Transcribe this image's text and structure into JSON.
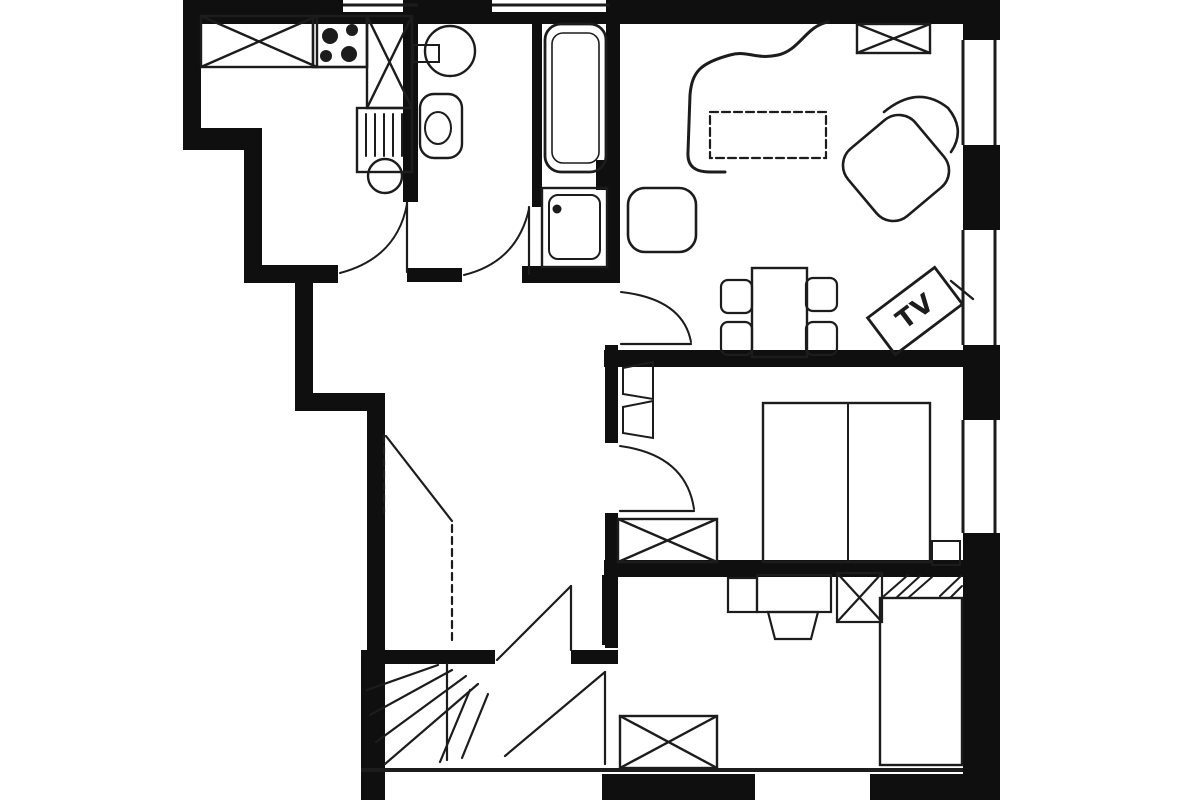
{
  "labels": {
    "tv": "TV"
  },
  "colors": {
    "paper": "#ffffff",
    "wall_ink": "#0f0f0f",
    "line_ink": "#1c1c1c"
  },
  "plan": {
    "walls": [
      {
        "name": "top-wall-west",
        "x": 183,
        "y": 0,
        "w": 160,
        "h": 24
      },
      {
        "name": "top-window1-sill",
        "x": 343,
        "y": 12,
        "w": 75,
        "h": 12
      },
      {
        "name": "top-wall-mid",
        "x": 418,
        "y": 0,
        "w": 74,
        "h": 24
      },
      {
        "name": "top-window2-sill",
        "x": 492,
        "y": 12,
        "w": 118,
        "h": 12
      },
      {
        "name": "top-wall-east",
        "x": 610,
        "y": 0,
        "w": 353,
        "h": 24
      },
      {
        "name": "corner-northeast",
        "x": 963,
        "y": 0,
        "w": 37,
        "h": 40
      },
      {
        "name": "left-wall-upper",
        "x": 183,
        "y": 0,
        "w": 18,
        "h": 150
      },
      {
        "name": "left-step-horizontal",
        "x": 183,
        "y": 128,
        "w": 79,
        "h": 22
      },
      {
        "name": "left-wall-mid",
        "x": 244,
        "y": 128,
        "w": 18,
        "h": 155
      },
      {
        "name": "kitchen-south-wall",
        "x": 244,
        "y": 265,
        "w": 94,
        "h": 18
      },
      {
        "name": "hall-west-wall-upper",
        "x": 295,
        "y": 283,
        "w": 18,
        "h": 127
      },
      {
        "name": "hall-step-horizontal",
        "x": 295,
        "y": 393,
        "w": 90,
        "h": 18
      },
      {
        "name": "hall-west-wall-lower",
        "x": 367,
        "y": 393,
        "w": 18,
        "h": 259
      },
      {
        "name": "left-wall-bottom",
        "x": 361,
        "y": 650,
        "w": 24,
        "h": 150
      },
      {
        "name": "kitchen-wc-wall",
        "x": 403,
        "y": 0,
        "w": 15,
        "h": 202
      },
      {
        "name": "wc-bath-wall",
        "x": 532,
        "y": 14,
        "w": 10,
        "h": 193
      },
      {
        "name": "bath-hall-wall",
        "x": 606,
        "y": 0,
        "w": 14,
        "h": 283
      },
      {
        "name": "wall-junction",
        "x": 596,
        "y": 160,
        "w": 24,
        "h": 30
      },
      {
        "name": "wc-south-wall",
        "x": 407,
        "y": 268,
        "w": 55,
        "h": 14
      },
      {
        "name": "bath-south-wall",
        "x": 522,
        "y": 266,
        "w": 98,
        "h": 17
      },
      {
        "name": "hall-east-wall-upper",
        "x": 605,
        "y": 345,
        "w": 13,
        "h": 98
      },
      {
        "name": "hall-east-wall-lower",
        "x": 605,
        "y": 513,
        "w": 13,
        "h": 135
      },
      {
        "name": "bedroom2-west-wall",
        "x": 602,
        "y": 575,
        "w": 16,
        "h": 70
      },
      {
        "name": "hall-south-wall-west",
        "x": 378,
        "y": 650,
        "w": 117,
        "h": 14
      },
      {
        "name": "hall-south-wall-east",
        "x": 571,
        "y": 650,
        "w": 47,
        "h": 14
      },
      {
        "name": "living-bedroom1-wall",
        "x": 604,
        "y": 350,
        "w": 359,
        "h": 17
      },
      {
        "name": "bedroom1-bedroom2-wall",
        "x": 604,
        "y": 560,
        "w": 359,
        "h": 17
      },
      {
        "name": "right-wall-1",
        "x": 963,
        "y": 145,
        "w": 37,
        "h": 85
      },
      {
        "name": "right-wall-2",
        "x": 963,
        "y": 345,
        "w": 37,
        "h": 75
      },
      {
        "name": "right-wall-3",
        "x": 963,
        "y": 533,
        "w": 37,
        "h": 267
      },
      {
        "name": "bottom-wall-mid",
        "x": 602,
        "y": 774,
        "w": 153,
        "h": 26
      },
      {
        "name": "bottom-wall-east",
        "x": 870,
        "y": 774,
        "w": 130,
        "h": 26
      }
    ],
    "window_lines": [
      {
        "name": "top-window1-line",
        "x1": 343,
        "y1": 5,
        "x2": 418,
        "y2": 5,
        "sw": 3
      },
      {
        "name": "top-window2-line",
        "x1": 492,
        "y1": 5,
        "x2": 610,
        "y2": 5,
        "sw": 3
      },
      {
        "name": "right-window1-inner",
        "x1": 963,
        "y1": 40,
        "x2": 963,
        "y2": 145,
        "sw": 3
      },
      {
        "name": "right-window1-outer",
        "x1": 995,
        "y1": 40,
        "x2": 995,
        "y2": 145,
        "sw": 3
      },
      {
        "name": "right-window2-inner",
        "x1": 963,
        "y1": 230,
        "x2": 963,
        "y2": 345,
        "sw": 3
      },
      {
        "name": "right-window2-outer",
        "x1": 995,
        "y1": 230,
        "x2": 995,
        "y2": 345,
        "sw": 3
      },
      {
        "name": "right-window3-inner",
        "x1": 963,
        "y1": 420,
        "x2": 963,
        "y2": 533,
        "sw": 3
      },
      {
        "name": "right-window3-outer",
        "x1": 995,
        "y1": 420,
        "x2": 995,
        "y2": 533,
        "sw": 3
      },
      {
        "name": "bottom-face-line",
        "x1": 361,
        "y1": 770,
        "x2": 963,
        "y2": 770,
        "sw": 4
      }
    ],
    "doors": [
      {
        "name": "kitchen-door",
        "lines": [
          {
            "x1": 407,
            "y1": 202,
            "x2": 407,
            "y2": 272
          }
        ],
        "arcs": [
          "M 340 273 Q 397 258 407 204"
        ]
      },
      {
        "name": "wc-door",
        "lines": [
          {
            "x1": 529,
            "y1": 207,
            "x2": 529,
            "y2": 274
          }
        ],
        "arcs": [
          "M 464 275 Q 517 262 529 209"
        ]
      },
      {
        "name": "living-room-door",
        "lines": [
          {
            "x1": 621,
            "y1": 344,
            "x2": 691,
            "y2": 344
          }
        ],
        "arcs": [
          "M 621 292 Q 683 299 691 342"
        ]
      },
      {
        "name": "bedroom1-door",
        "lines": [
          {
            "x1": 620,
            "y1": 511,
            "x2": 694,
            "y2": 511
          }
        ],
        "arcs": [
          "M 620 446 Q 686 455 694 509"
        ]
      },
      {
        "name": "entrance-door",
        "lines": [
          {
            "x1": 386,
            "y1": 436,
            "x2": 452,
            "y2": 521
          },
          {
            "x1": 384,
            "y1": 435,
            "x2": 384,
            "y2": 513,
            "dash": "7 5"
          },
          {
            "x1": 452,
            "y1": 525,
            "x2": 452,
            "y2": 645,
            "dash": "7 5"
          }
        ],
        "arcs": []
      },
      {
        "name": "stair-door",
        "lines": [
          {
            "x1": 571,
            "y1": 586,
            "x2": 571,
            "y2": 650
          },
          {
            "x1": 497,
            "y1": 660,
            "x2": 571,
            "y2": 586
          }
        ],
        "arcs": []
      },
      {
        "name": "bedroom2-door",
        "lines": [
          {
            "x1": 605,
            "y1": 672,
            "x2": 605,
            "y2": 764
          },
          {
            "x1": 505,
            "y1": 756,
            "x2": 605,
            "y2": 672
          }
        ],
        "arcs": []
      }
    ],
    "stairs": [
      {
        "x1": 367,
        "y1": 690,
        "x2": 438,
        "y2": 665
      },
      {
        "x1": 370,
        "y1": 715,
        "x2": 452,
        "y2": 670
      },
      {
        "x1": 376,
        "y1": 742,
        "x2": 466,
        "y2": 676
      },
      {
        "x1": 385,
        "y1": 764,
        "x2": 478,
        "y2": 684
      },
      {
        "x1": 440,
        "y1": 762,
        "x2": 470,
        "y2": 690
      },
      {
        "x1": 462,
        "y1": 758,
        "x2": 488,
        "y2": 694
      },
      {
        "x1": 447,
        "y1": 664,
        "x2": 447,
        "y2": 760
      }
    ],
    "furniture": [
      {
        "name": "kitchen-counter",
        "type": "xrect",
        "x": 201,
        "y": 16,
        "w": 116,
        "h": 51,
        "sw": 2.4
      },
      {
        "name": "stove",
        "type": "rect",
        "x": 313,
        "y": 16,
        "w": 54,
        "h": 51,
        "sw": 2.6
      },
      {
        "name": "stove-burner-1",
        "type": "circle",
        "cx": 330,
        "cy": 36,
        "r": 8,
        "fill": true
      },
      {
        "name": "stove-burner-2",
        "type": "circle",
        "cx": 352,
        "cy": 30,
        "r": 6,
        "fill": true
      },
      {
        "name": "stove-burner-3",
        "type": "circle",
        "cx": 326,
        "cy": 56,
        "r": 6,
        "fill": true
      },
      {
        "name": "stove-burner-4",
        "type": "circle",
        "cx": 349,
        "cy": 54,
        "r": 8,
        "fill": true
      },
      {
        "name": "kitchen-tall-cabinet",
        "type": "xrect",
        "x": 367,
        "y": 16,
        "w": 45,
        "h": 92,
        "sw": 2.4
      },
      {
        "name": "sink-cabinet",
        "type": "rect",
        "x": 357,
        "y": 108,
        "w": 55,
        "h": 64,
        "sw": 2.4
      },
      {
        "name": "sink-drainer",
        "type": "lines",
        "sw": 2,
        "pts": [
          [
            366,
            114,
            366,
            156
          ],
          [
            375,
            114,
            375,
            156
          ],
          [
            384,
            114,
            384,
            156
          ],
          [
            393,
            114,
            393,
            156
          ],
          [
            402,
            114,
            402,
            156
          ]
        ]
      },
      {
        "name": "sink-bowl",
        "type": "circle",
        "cx": 385,
        "cy": 176,
        "r": 17,
        "sw": 2.4
      },
      {
        "name": "washbasin",
        "type": "circle",
        "cx": 450,
        "cy": 51,
        "r": 25,
        "sw": 2.4
      },
      {
        "name": "washbasin-shelf",
        "type": "rect",
        "x": 413,
        "y": 45,
        "w": 26,
        "h": 17,
        "sw": 2
      },
      {
        "name": "toilet",
        "type": "rect",
        "x": 420,
        "y": 94,
        "w": 42,
        "h": 64,
        "rx": 14,
        "sw": 2.4
      },
      {
        "name": "toilet-bowl",
        "type": "ellipse",
        "cx": 438,
        "cy": 128,
        "rx": 13,
        "ry": 16,
        "sw": 2
      },
      {
        "name": "bathtub",
        "type": "rect",
        "x": 545,
        "y": 24,
        "w": 61,
        "h": 148,
        "rx": 16,
        "sw": 2.8
      },
      {
        "name": "bathtub-inner",
        "type": "rect",
        "x": 552,
        "y": 33,
        "w": 47,
        "h": 130,
        "rx": 11,
        "sw": 1.6
      },
      {
        "name": "shower",
        "type": "rect",
        "x": 542,
        "y": 188,
        "w": 65,
        "h": 79,
        "sw": 2.4
      },
      {
        "name": "shower-tray",
        "type": "rect",
        "x": 549,
        "y": 195,
        "w": 51,
        "h": 64,
        "rx": 9,
        "sw": 2
      },
      {
        "name": "shower-drain",
        "type": "circle",
        "cx": 557,
        "cy": 209,
        "r": 4.5,
        "fill": true
      },
      {
        "name": "living-cabinet",
        "type": "xrect",
        "x": 857,
        "y": 24,
        "w": 73,
        "h": 29,
        "sw": 2.4
      },
      {
        "name": "sofa",
        "type": "path",
        "d": "M 828 22 C 806 26 800 50 778 55 C 755 60 748 50 730 55 C 700 63 692 72 690 95 L 688 152 C 687 167 696 172 710 172 L 725 172",
        "sw": 3
      },
      {
        "name": "side-table",
        "type": "rect",
        "x": 628,
        "y": 188,
        "w": 68,
        "h": 64,
        "rx": 17,
        "sw": 2.6
      },
      {
        "name": "coffee-table",
        "type": "rect",
        "x": 710,
        "y": 112,
        "w": 116,
        "h": 46,
        "sw": 2.2,
        "dash": "8 4"
      },
      {
        "name": "armchair",
        "type": "rect",
        "x": 852,
        "y": 124,
        "w": 88,
        "h": 88,
        "rx": 22,
        "sw": 2.6,
        "rot": [
          -40,
          896,
          168
        ]
      },
      {
        "name": "armchair-back",
        "type": "path",
        "d": "M 884 112 Q 918 84 948 108 Q 966 130 951 152",
        "sw": 2.6
      },
      {
        "name": "dining-table",
        "type": "rect",
        "x": 752,
        "y": 268,
        "w": 55,
        "h": 89,
        "sw": 2.4
      },
      {
        "name": "dining-chair-1",
        "type": "rect",
        "x": 721,
        "y": 280,
        "w": 31,
        "h": 33,
        "rx": 7,
        "sw": 2.2
      },
      {
        "name": "dining-chair-2",
        "type": "rect",
        "x": 721,
        "y": 322,
        "w": 31,
        "h": 33,
        "rx": 7,
        "sw": 2.2
      },
      {
        "name": "dining-chair-3",
        "type": "rect",
        "x": 806,
        "y": 278,
        "w": 31,
        "h": 33,
        "rx": 7,
        "sw": 2.2
      },
      {
        "name": "dining-chair-4",
        "type": "rect",
        "x": 806,
        "y": 322,
        "w": 31,
        "h": 33,
        "rx": 7,
        "sw": 2.2
      },
      {
        "name": "tv-screen",
        "type": "rect",
        "x": 873,
        "y": 288,
        "w": 84,
        "h": 46,
        "sw": 2.8,
        "rot": [
          -37,
          915,
          311
        ]
      },
      {
        "name": "tv-label",
        "type": "text",
        "x": 915,
        "y": 312,
        "size": 26,
        "rot": [
          -37,
          915,
          311
        ],
        "bind": "labels.tv"
      },
      {
        "name": "tv-stand-line",
        "type": "lines",
        "sw": 2.4,
        "pts": [
          [
            951,
            281,
            973,
            299
          ]
        ]
      },
      {
        "name": "double-bed",
        "type": "rect",
        "x": 763,
        "y": 403,
        "w": 167,
        "h": 159,
        "sw": 2.4
      },
      {
        "name": "double-bed-divider",
        "type": "lines",
        "sw": 2,
        "pts": [
          [
            848,
            403,
            848,
            562
          ]
        ]
      },
      {
        "name": "nightstand",
        "type": "rect",
        "x": 932,
        "y": 541,
        "w": 28,
        "h": 24,
        "sw": 2
      },
      {
        "name": "bedroom1-wardrobe",
        "type": "xrect",
        "x": 618,
        "y": 519,
        "w": 99,
        "h": 43,
        "sw": 2.4
      },
      {
        "name": "wardrobe-open-doors",
        "type": "path",
        "d": "M 653 362 L 623 368 L 623 394 L 653 399 Z M 653 401 L 623 407 L 623 433 L 653 438 Z",
        "sw": 2
      },
      {
        "name": "desk-side",
        "type": "rect",
        "x": 728,
        "y": 578,
        "w": 29,
        "h": 34,
        "sw": 2.2
      },
      {
        "name": "desk",
        "type": "rect",
        "x": 757,
        "y": 575,
        "w": 74,
        "h": 37,
        "sw": 2.2
      },
      {
        "name": "desk-chair",
        "type": "path",
        "d": "M 768 612 L 818 612 L 811 639 L 775 639 Z",
        "sw": 2.2
      },
      {
        "name": "bedroom2-cabinet",
        "type": "xrect",
        "x": 837,
        "y": 573,
        "w": 45,
        "h": 49,
        "sw": 2.2
      },
      {
        "name": "bed-head-hatch",
        "type": "lines",
        "sw": 2,
        "pts": [
          [
            884,
            596,
            908,
            575
          ],
          [
            896,
            598,
            920,
            576
          ],
          [
            908,
            598,
            932,
            577
          ]
        ]
      },
      {
        "name": "corner-hatch",
        "type": "lines",
        "sw": 2,
        "pts": [
          [
            940,
            596,
            961,
            576
          ],
          [
            950,
            598,
            962,
            586
          ]
        ]
      },
      {
        "name": "single-bed",
        "type": "rect",
        "x": 880,
        "y": 598,
        "w": 82,
        "h": 167,
        "sw": 2.4
      },
      {
        "name": "bedroom2-wardrobe",
        "type": "xrect",
        "x": 620,
        "y": 716,
        "w": 97,
        "h": 52,
        "sw": 2.4
      }
    ]
  }
}
